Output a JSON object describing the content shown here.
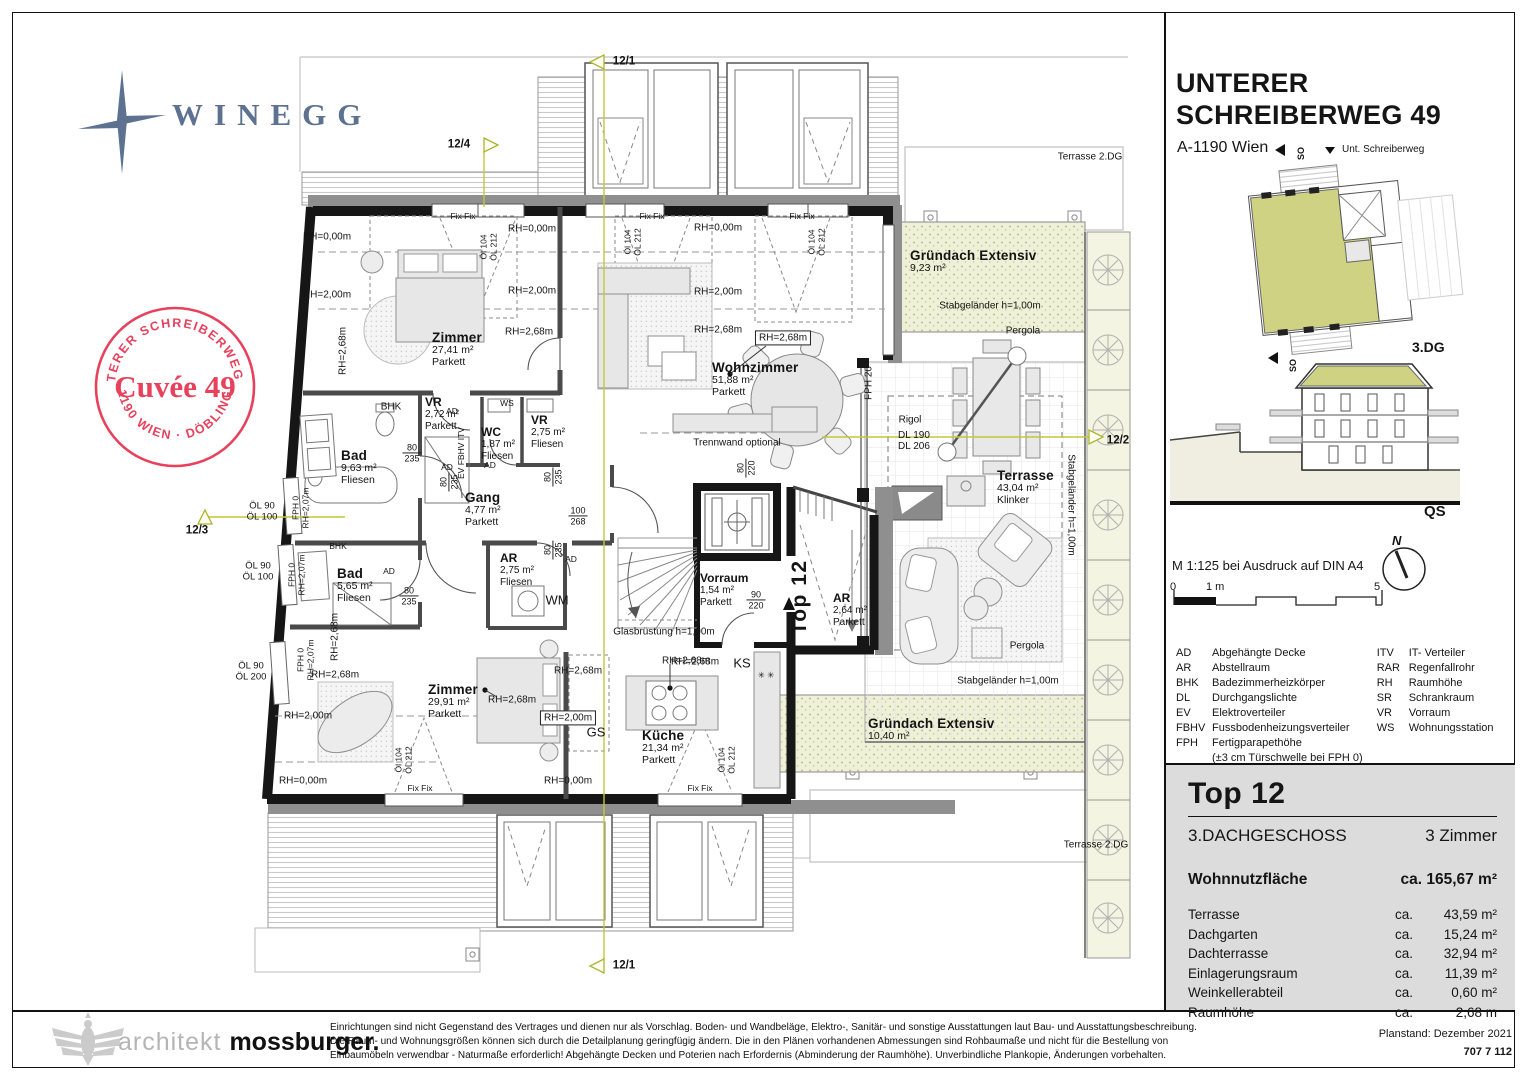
{
  "branding": {
    "logo_text": "WINEGG"
  },
  "stamp": {
    "top": "UNTERER SCHREIBERWEG 49",
    "center": "Cuvée 49",
    "bottom": "· 1190 WIEN · DÖBLING ·",
    "color": "#e8415c"
  },
  "header": {
    "title_line1": "UNTERER",
    "title_line2": "SCHREIBERWEG 49",
    "subtitle": "A-1190 Wien"
  },
  "siteplan": {
    "so_top": "SO",
    "street": "Unt. Schreiberweg",
    "so_bottom": "SO",
    "floor_label": "3.DG"
  },
  "section": {
    "label": "QS"
  },
  "scale": {
    "text": "M 1:125 bei Ausdruck auf DIN A4",
    "north": "N",
    "zero": "0",
    "one": "1 m",
    "five": "5"
  },
  "legend": {
    "left": [
      {
        "abbr": "AD",
        "desc": "Abgehängte Decke"
      },
      {
        "abbr": "AR",
        "desc": "Abstellraum"
      },
      {
        "abbr": "BHK",
        "desc": "Badezimmerheizkörper"
      },
      {
        "abbr": "DL",
        "desc": "Durchgangslichte"
      },
      {
        "abbr": "EV",
        "desc": "Elektroverteiler"
      },
      {
        "abbr": "FBHV",
        "desc": "Fussbodenheizungsverteiler"
      },
      {
        "abbr": "FPH",
        "desc": "Fertigparapethöhe"
      }
    ],
    "right": [
      {
        "abbr": "ITV",
        "desc": "IT- Verteiler"
      },
      {
        "abbr": "RAR",
        "desc": "Regenfallrohr"
      },
      {
        "abbr": "RH",
        "desc": "Raumhöhe"
      },
      {
        "abbr": "SR",
        "desc": "Schrankraum"
      },
      {
        "abbr": "VR",
        "desc": "Vorraum"
      },
      {
        "abbr": "WS",
        "desc": "Wohnungsstation"
      }
    ],
    "fph_note": "(±3 cm Türschwelle bei FPH 0)"
  },
  "unit": {
    "name": "Top 12",
    "floor": "3.DACHGESCHOSS",
    "rooms": "3 Zimmer",
    "area_label": "Wohnnutzfläche",
    "area_value": "ca. 165,67 m²",
    "rows": [
      {
        "label": "Terrasse",
        "ca": "ca.",
        "value": "43,59 m²"
      },
      {
        "label": "Dachgarten",
        "ca": "ca.",
        "value": "15,24 m²"
      },
      {
        "label": "Dachterrasse",
        "ca": "ca.",
        "value": "32,94 m²"
      },
      {
        "label": "Einlagerungsraum",
        "ca": "ca.",
        "value": "11,39 m²"
      },
      {
        "label": "Weinkellerabteil",
        "ca": "ca.",
        "value": "0,60 m²"
      },
      {
        "label": "Raumhöhe",
        "ca": "ca.",
        "value": "2,68 m"
      }
    ]
  },
  "footer": {
    "architect_light": "architekt ",
    "architect_bold": "mossburger.",
    "disclaimer_lines": [
      "Einrichtungen sind nicht Gegenstand des Vertrages und dienen nur als Vorschlag. Boden- und Wandbeläge, Elektro-, Sanitär- und sonstige Ausstattungen laut Bau- und Ausstattungsbeschreibung.",
      "Die Raum- und Wohnungsgrößen können sich durch die Detailplanung geringfügig ändern. Die in den Plänen vorhandenen Abmessungen sind Rohbaumaße und nicht für die Bestellung von",
      "Einbaumöbeln verwendbar - Naturmaße erforderlich! Abgehängte Decken und Poterien nach Erfordernis (Abminderung der Raumhöhe). Unverbindliche Plankopie, Änderungen vorbehalten."
    ],
    "planstand": "Planstand: Dezember 2021",
    "plan_number": "707 7 112"
  },
  "plan": {
    "labels": [
      {
        "x": 432,
        "y": 330,
        "c": "room",
        "t": [
          "Zimmer",
          "27,41 m²",
          "Parkett"
        ]
      },
      {
        "x": 712,
        "y": 360,
        "c": "room",
        "t": [
          "Wohnzimmer",
          "51,88 m²",
          "Parkett"
        ]
      },
      {
        "x": 341,
        "y": 448,
        "c": "room",
        "t": [
          "Bad",
          "9,63 m²",
          "Fliesen"
        ]
      },
      {
        "x": 337,
        "y": 566,
        "c": "room",
        "t": [
          "Bad",
          "5,65 m²",
          "Fliesen"
        ]
      },
      {
        "x": 425,
        "y": 396,
        "c": "room2",
        "t": [
          "VR",
          "2,72 m²",
          "Parkett"
        ]
      },
      {
        "x": 481,
        "y": 426,
        "c": "room2",
        "t": [
          "WC",
          "1,87 m²",
          "Fliesen"
        ]
      },
      {
        "x": 531,
        "y": 414,
        "c": "room2",
        "t": [
          "VR",
          "2,75 m²",
          "Fliesen"
        ]
      },
      {
        "x": 465,
        "y": 490,
        "c": "room",
        "t": [
          "Gang",
          "4,77 m²",
          "Parkett"
        ]
      },
      {
        "x": 500,
        "y": 552,
        "c": "room2",
        "t": [
          "AR",
          "2,75 m²",
          "Fliesen"
        ]
      },
      {
        "x": 833,
        "y": 592,
        "c": "room2",
        "t": [
          "AR",
          "2,64 m²",
          "Parkett"
        ]
      },
      {
        "x": 700,
        "y": 572,
        "c": "room2",
        "t": [
          "Vorraum",
          "1,54 m²",
          "Parkett"
        ]
      },
      {
        "x": 428,
        "y": 682,
        "c": "room",
        "t": [
          "Zimmer",
          "29,91 m²",
          "Parkett"
        ]
      },
      {
        "x": 642,
        "y": 728,
        "c": "room",
        "t": [
          "Küche",
          "21,34 m²",
          "Parkett"
        ]
      },
      {
        "x": 997,
        "y": 468,
        "c": "room",
        "t": [
          "Terrasse",
          "43,04 m²",
          "Klinker"
        ]
      },
      {
        "x": 910,
        "y": 248,
        "c": "room",
        "t": [
          "Gründach Extensiv",
          "9,23 m²"
        ]
      },
      {
        "x": 868,
        "y": 716,
        "c": "room",
        "t": [
          "Gründach Extensiv",
          "10,40 m²"
        ]
      },
      {
        "x": 737,
        "y": 443,
        "c": "small",
        "t": [
          "Trennwand optional"
        ]
      },
      {
        "x": 664,
        "y": 632,
        "c": "small",
        "t": [
          "Glasbrüstung h=1,00m"
        ]
      },
      {
        "x": 990,
        "y": 306,
        "c": "small",
        "t": [
          "Stabgeländer h=1,00m"
        ]
      },
      {
        "x": 1008,
        "y": 681,
        "c": "small",
        "t": [
          "Stabgeländer h=1,00m"
        ]
      },
      {
        "x": 1071,
        "y": 505,
        "c": "small",
        "r": 90,
        "t": [
          "Stabgeländer h=1,00m"
        ]
      },
      {
        "x": 910,
        "y": 420,
        "c": "small",
        "t": [
          "Rigol"
        ]
      },
      {
        "x": 1023,
        "y": 331,
        "c": "small",
        "t": [
          "Pergola"
        ]
      },
      {
        "x": 1027,
        "y": 646,
        "c": "small",
        "t": [
          "Pergola"
        ]
      },
      {
        "x": 898,
        "y": 430,
        "c": "note",
        "t": [
          "DL 190",
          "DL 206"
        ]
      },
      {
        "x": 869,
        "y": 383,
        "c": "small",
        "r": -90,
        "t": [
          "FPH 20"
        ]
      },
      {
        "x": 391,
        "y": 407,
        "c": "small",
        "t": [
          "BHK"
        ]
      },
      {
        "x": 338,
        "y": 547,
        "c": "tiny",
        "t": [
          "BHK"
        ]
      },
      {
        "x": 557,
        "y": 601,
        "c": "med",
        "t": [
          "WM"
        ]
      },
      {
        "x": 596,
        "y": 733,
        "c": "med",
        "t": [
          "GS"
        ]
      },
      {
        "x": 742,
        "y": 664,
        "c": "med",
        "t": [
          "KS"
        ]
      },
      {
        "x": 766,
        "y": 676,
        "c": "tiny",
        "t": [
          "✳ ✳"
        ]
      },
      {
        "x": 1090,
        "y": 157,
        "c": "small",
        "t": [
          "Terrasse 2.DG"
        ]
      },
      {
        "x": 1096,
        "y": 845,
        "c": "small",
        "t": [
          "Terrasse 2.DG"
        ]
      },
      {
        "x": 507,
        "y": 404,
        "c": "tiny",
        "t": [
          "WS"
        ]
      },
      {
        "x": 800,
        "y": 597,
        "c": "big",
        "r": -90,
        "t": [
          "Top 12"
        ]
      },
      {
        "x": 452,
        "y": 412,
        "c": "tiny",
        "t": [
          "AD"
        ]
      },
      {
        "x": 447,
        "y": 468,
        "c": "tiny",
        "t": [
          "AD"
        ]
      },
      {
        "x": 389,
        "y": 572,
        "c": "tiny",
        "t": [
          "AD"
        ]
      },
      {
        "x": 490,
        "y": 466,
        "c": "tiny",
        "t": [
          "AD"
        ]
      },
      {
        "x": 571,
        "y": 560,
        "c": "tiny",
        "t": [
          "AD"
        ]
      },
      {
        "x": 462,
        "y": 453,
        "c": "tiny",
        "r": -90,
        "t": [
          "EV FBHV ITV"
        ]
      },
      {
        "x": 327,
        "y": 237,
        "c": "small",
        "t": [
          "RH=0,00m"
        ]
      },
      {
        "x": 532,
        "y": 229,
        "c": "small",
        "t": [
          "RH=0,00m"
        ]
      },
      {
        "x": 718,
        "y": 228,
        "c": "small",
        "t": [
          "RH=0,00m"
        ]
      },
      {
        "x": 327,
        "y": 295,
        "c": "small",
        "t": [
          "RH=2,00m"
        ]
      },
      {
        "x": 532,
        "y": 291,
        "c": "small",
        "t": [
          "RH=2,00m"
        ]
      },
      {
        "x": 718,
        "y": 292,
        "c": "small",
        "t": [
          "RH=2,00m"
        ]
      },
      {
        "x": 343,
        "y": 351,
        "c": "small",
        "r": -90,
        "t": [
          "RH=2,68m"
        ]
      },
      {
        "x": 529,
        "y": 332,
        "c": "small",
        "t": [
          "RH=2,68m"
        ]
      },
      {
        "x": 718,
        "y": 330,
        "c": "small",
        "t": [
          "RH=2,68m"
        ]
      },
      {
        "x": 783,
        "y": 338,
        "c": "boxed",
        "t": [
          "RH=2,68m"
        ]
      },
      {
        "x": 335,
        "y": 637,
        "c": "small",
        "r": -90,
        "t": [
          "RH=2,68m"
        ]
      },
      {
        "x": 335,
        "y": 675,
        "c": "small",
        "t": [
          "RH=2,68m"
        ]
      },
      {
        "x": 578,
        "y": 671,
        "c": "small",
        "t": [
          "RH=2,68m"
        ]
      },
      {
        "x": 695,
        "y": 662,
        "c": "small",
        "t": [
          "RH=2,68m"
        ]
      },
      {
        "x": 512,
        "y": 700,
        "c": "small",
        "t": [
          "RH=2,68m"
        ]
      },
      {
        "x": 308,
        "y": 716,
        "c": "small",
        "t": [
          "RH=2,00m"
        ]
      },
      {
        "x": 568,
        "y": 718,
        "c": "boxed",
        "t": [
          "RH=2,00m"
        ]
      },
      {
        "x": 303,
        "y": 781,
        "c": "small",
        "t": [
          "RH=0,00m"
        ]
      },
      {
        "x": 568,
        "y": 781,
        "c": "small",
        "t": [
          "RH=0,00m"
        ]
      },
      {
        "x": 686,
        "y": 661,
        "c": "small",
        "t": [
          "RH=2,68m"
        ]
      },
      {
        "x": 463,
        "y": 217,
        "c": "tiny",
        "t": [
          "Fix Fix"
        ]
      },
      {
        "x": 652,
        "y": 217,
        "c": "tiny",
        "t": [
          "Fix Fix"
        ]
      },
      {
        "x": 802,
        "y": 217,
        "c": "tiny",
        "t": [
          "Fix Fix"
        ]
      },
      {
        "x": 420,
        "y": 789,
        "c": "tiny",
        "t": [
          "Fix Fix"
        ]
      },
      {
        "x": 700,
        "y": 789,
        "c": "tiny",
        "t": [
          "Fix Fix"
        ]
      },
      {
        "x": 489,
        "y": 247,
        "c": "tiny",
        "r": -90,
        "t": [
          "Öl 104",
          "ÖL 212"
        ]
      },
      {
        "x": 633,
        "y": 242,
        "c": "tiny",
        "r": -90,
        "t": [
          "Öl 104",
          "ÖL 212"
        ]
      },
      {
        "x": 817,
        "y": 242,
        "c": "tiny",
        "r": -90,
        "t": [
          "Öl 104",
          "ÖL 212"
        ]
      },
      {
        "x": 404,
        "y": 760,
        "c": "tiny",
        "r": -90,
        "t": [
          "Öl 104",
          "ÖL 212"
        ]
      },
      {
        "x": 727,
        "y": 760,
        "c": "tiny",
        "r": -90,
        "t": [
          "Öl 104",
          "ÖL 212"
        ]
      },
      {
        "x": 262,
        "y": 512,
        "c": "dim2",
        "t": [
          "ÖL 90",
          "ÖL 100"
        ]
      },
      {
        "x": 258,
        "y": 572,
        "c": "dim2",
        "t": [
          "ÖL 90",
          "ÖL 100"
        ]
      },
      {
        "x": 251,
        "y": 672,
        "c": "dim2",
        "t": [
          "ÖL 90",
          "ÖL 200"
        ]
      },
      {
        "x": 301,
        "y": 508,
        "c": "tiny",
        "r": -90,
        "t": [
          "FPH 0",
          "RH=2,07m"
        ]
      },
      {
        "x": 297,
        "y": 575,
        "c": "tiny",
        "r": -90,
        "t": [
          "FPH 0",
          "RH=2,07m"
        ]
      },
      {
        "x": 306,
        "y": 660,
        "c": "tiny",
        "r": -90,
        "t": [
          "FPH 0",
          "RH=2,07m"
        ]
      },
      {
        "x": 412,
        "y": 453,
        "c": "dim",
        "t": [
          "80",
          "235"
        ]
      },
      {
        "x": 449,
        "y": 482,
        "c": "dim",
        "r": -90,
        "t": [
          "80",
          "235"
        ]
      },
      {
        "x": 553,
        "y": 477,
        "c": "dim",
        "r": -90,
        "t": [
          "80",
          "235"
        ]
      },
      {
        "x": 553,
        "y": 550,
        "c": "dim",
        "r": -90,
        "t": [
          "80",
          "235"
        ]
      },
      {
        "x": 409,
        "y": 596,
        "c": "dim",
        "t": [
          "80",
          "235"
        ]
      },
      {
        "x": 578,
        "y": 516,
        "c": "dim",
        "t": [
          "100",
          "268"
        ]
      },
      {
        "x": 756,
        "y": 600,
        "c": "dim",
        "t": [
          "90",
          "220"
        ]
      },
      {
        "x": 746,
        "y": 468,
        "c": "dim",
        "r": -90,
        "t": [
          "80",
          "220"
        ]
      },
      {
        "x": 624,
        "y": 62,
        "c": "marker",
        "t": [
          "12/1"
        ]
      },
      {
        "x": 624,
        "y": 966,
        "c": "marker",
        "t": [
          "12/1"
        ]
      },
      {
        "x": 459,
        "y": 145,
        "c": "marker",
        "t": [
          "12/4"
        ]
      },
      {
        "x": 197,
        "y": 531,
        "c": "marker",
        "t": [
          "12/3"
        ]
      },
      {
        "x": 1118,
        "y": 441,
        "c": "marker",
        "t": [
          "12/2"
        ]
      }
    ]
  }
}
